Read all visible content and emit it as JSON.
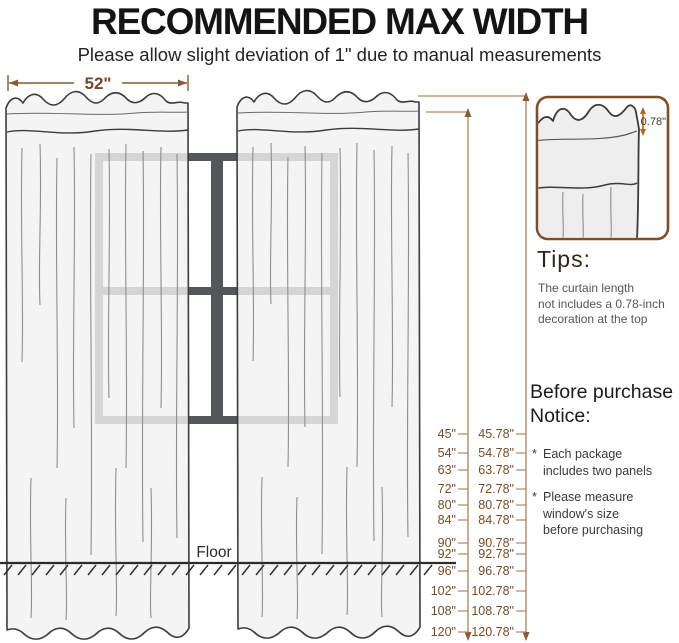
{
  "header": {
    "title": "RECOMMENDED MAX WIDTH",
    "subtitle": "Please allow slight deviation of 1\" due to manual measurements"
  },
  "diagram": {
    "panel_width_label": "52\"",
    "floor_label": "Floor"
  },
  "scale": {
    "rows": [
      {
        "size": "45\"",
        "total": "45.78\""
      },
      {
        "size": "54\"",
        "total": "54.78\""
      },
      {
        "size": "63\"",
        "total": "63.78\""
      },
      {
        "size": "72\"",
        "total": "72.78\""
      },
      {
        "size": "80\"",
        "total": "80.78\""
      },
      {
        "size": "84\"",
        "total": "84.78\""
      },
      {
        "size": "90\"",
        "total": "90.78\""
      },
      {
        "size": "92\"",
        "total": "92.78\""
      },
      {
        "size": "96\"",
        "total": "96.78\""
      },
      {
        "size": "102\"",
        "total": "102.78\""
      },
      {
        "size": "108\"",
        "total": "108.78\""
      },
      {
        "size": "120\"",
        "total": "120.78\""
      }
    ]
  },
  "inset": {
    "decoration_height_label": "0.78\""
  },
  "tips": {
    "heading": "Tips:",
    "lines": [
      "The curtain length",
      "not includes a 0.78-inch",
      "decoration at the top"
    ]
  },
  "notice": {
    "heading_lines": [
      "Before purchase",
      "Notice:"
    ],
    "bullets": [
      {
        "marker": "*",
        "lines": [
          "Each package",
          "includes two panels"
        ]
      },
      {
        "marker": "*",
        "lines": [
          "Please measure",
          "window's size",
          "before purchasing"
        ]
      }
    ]
  },
  "colors": {
    "accent_dark_brown": "#7b4b26",
    "accent_line_tan": "#b08c63",
    "accent_orange": "#b5651d",
    "curtain_fill": "#f0f0f0",
    "window_frame": "#54575a",
    "floor": "#2b2b2b"
  }
}
